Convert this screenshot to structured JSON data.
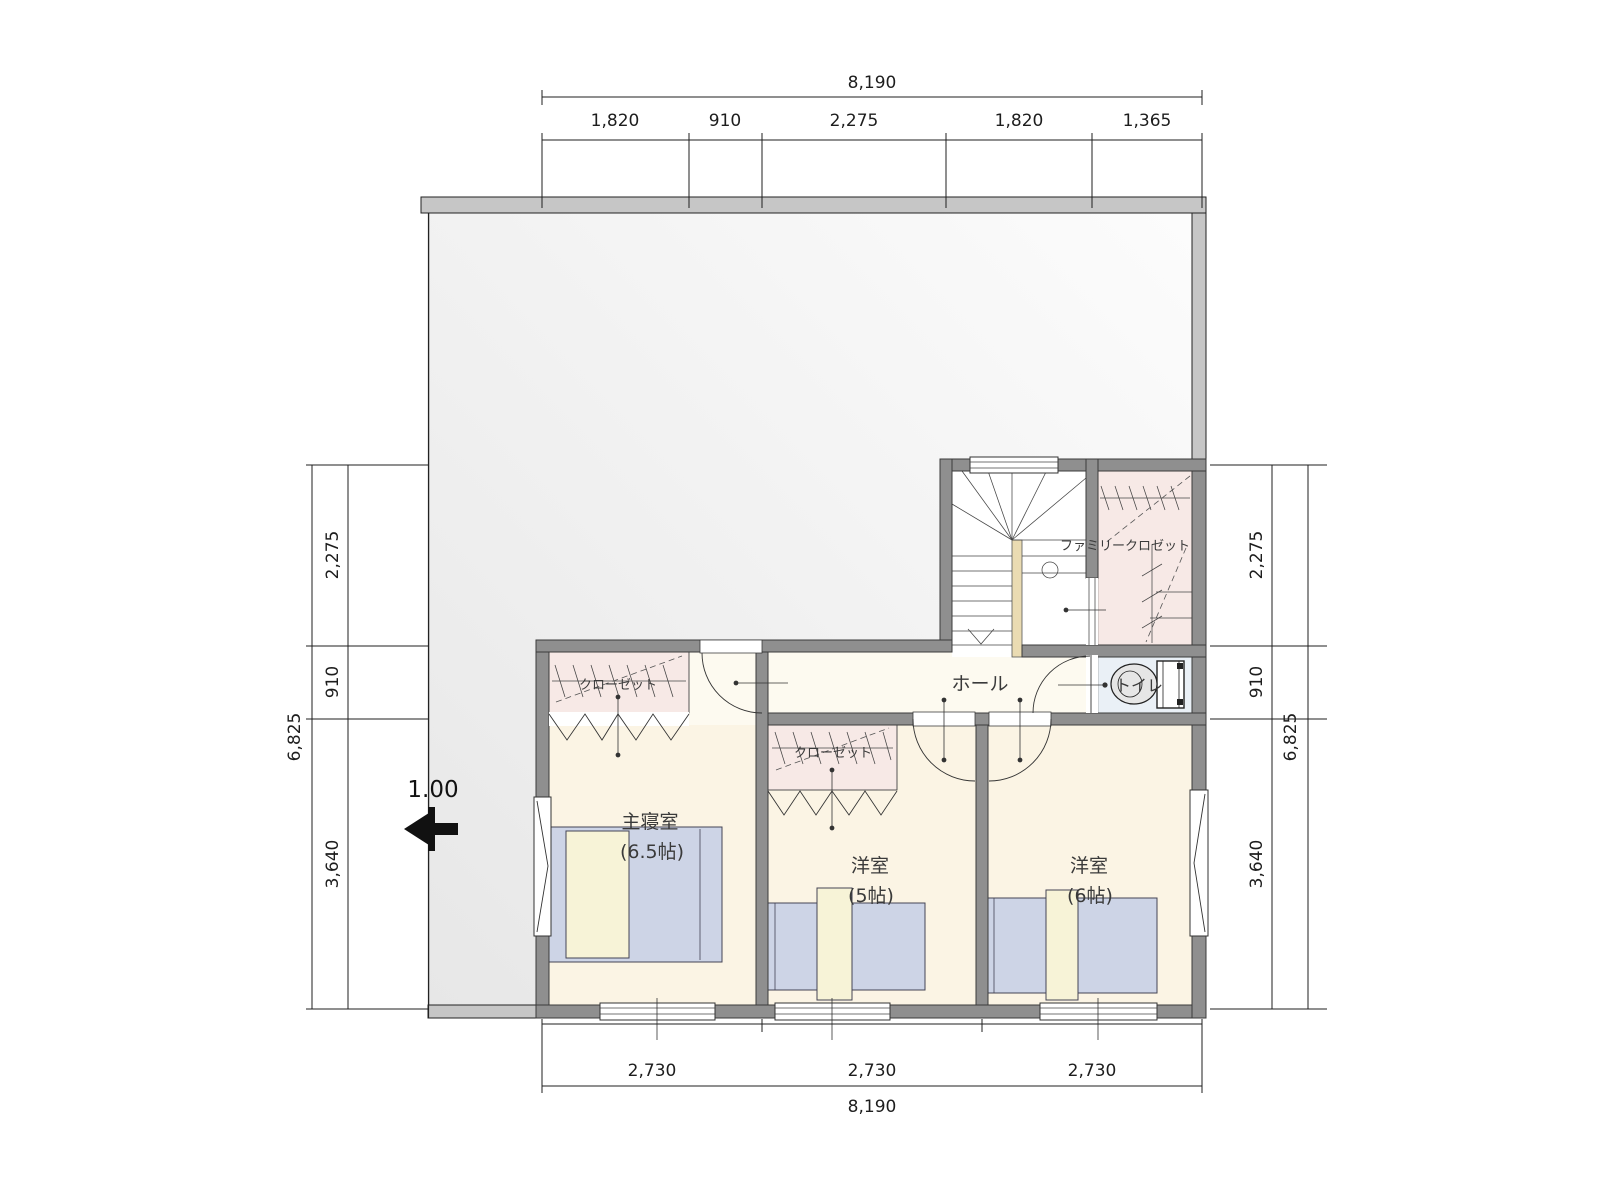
{
  "plan": {
    "type": "floor-plan",
    "floor": "2F",
    "slope_arrow_label": "1.00"
  },
  "dimensions": {
    "top": {
      "total": "8,190",
      "segments": [
        "1,820",
        "910",
        "2,275",
        "1,820",
        "1,365"
      ]
    },
    "bottom": {
      "total": "8,190",
      "segments": [
        "2,730",
        "2,730",
        "2,730"
      ]
    },
    "left": {
      "total": "6,825",
      "segments": [
        "2,275",
        "910",
        "3,640"
      ]
    },
    "right": {
      "total": "6,825",
      "segments": [
        "2,275",
        "910",
        "3,640"
      ]
    }
  },
  "rooms": {
    "master": {
      "name": "主寝室",
      "size": "(6.5帖)"
    },
    "west5": {
      "name": "洋室",
      "size": "(5帖)"
    },
    "west6": {
      "name": "洋室",
      "size": "(6帖)"
    },
    "hall": {
      "name": "ホール"
    },
    "toilet": {
      "name": "トイレ"
    },
    "family_closet": {
      "name": "ファミリークロゼット"
    },
    "closet_master": {
      "name": "クローゼット"
    },
    "closet_west5": {
      "name": "クローゼット"
    }
  },
  "colors": {
    "wall": "#8f8f8f",
    "roof_edge": "#c6c6c6",
    "room_floor": "#fbf4e4",
    "closet_floor": "#f7e9e6",
    "toilet_floor": "#eaf0f6",
    "bed": "#cdd4e6",
    "pillow": "#f7f3d7",
    "stair_newel": "#eadbb2"
  }
}
